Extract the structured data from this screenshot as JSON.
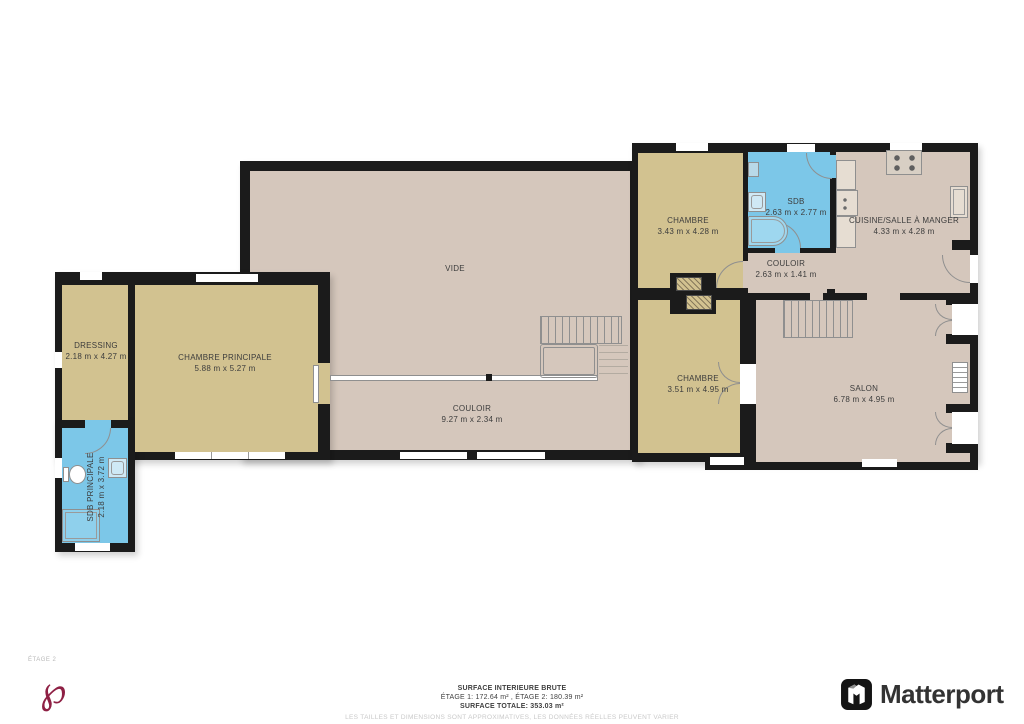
{
  "colors": {
    "wall": "#1b1b1b",
    "floor_common": "#d5c7bc",
    "floor_room": "#d2c290",
    "floor_bath": "#7cc7e8",
    "label_text": "#3c3c3c",
    "logo_red": "#8e2044"
  },
  "rooms": [
    {
      "id": "dressing",
      "name": "DRESSING",
      "dims": "2.18 m x 4.27 m"
    },
    {
      "id": "chambre-principale",
      "name": "CHAMBRE PRINCIPALE",
      "dims": "5.88 m x 5.27 m"
    },
    {
      "id": "sdb-principale",
      "name": "SDB PRINCIPALE",
      "dims": "2.18 m x 3.72 m"
    },
    {
      "id": "vide",
      "name": "VIDE",
      "dims": ""
    },
    {
      "id": "couloir",
      "name": "COULOIR",
      "dims": "9.27 m x 2.34 m"
    },
    {
      "id": "chambre-haut",
      "name": "CHAMBRE",
      "dims": "3.43 m x 4.28 m"
    },
    {
      "id": "sdb",
      "name": "SDB",
      "dims": "2.63 m x 2.77 m"
    },
    {
      "id": "cuisine",
      "name": "CUISINE/SALLE À MANGER",
      "dims": "4.33 m x 4.28 m"
    },
    {
      "id": "couloir-2",
      "name": "COULOIR",
      "dims": "2.63 m x 1.41 m"
    },
    {
      "id": "chambre-bas",
      "name": "CHAMBRE",
      "dims": "3.51 m x 4.95 m"
    },
    {
      "id": "salon",
      "name": "SALON",
      "dims": "6.78 m x 4.95 m"
    }
  ],
  "footer": {
    "floor_label": "ÉTAGE 2",
    "monogram": "℘",
    "line1": "SURFACE INTERIEURE BRUTE",
    "line2": "ÉTAGE 1: 172.64 m² , ÉTAGE 2: 180.39 m²",
    "line3": "SURFACE TOTALE: 353.03 m²",
    "disclaimer": "LES TAILLES ET DIMENSIONS SONT APPROXIMATIVES, LES DONNÉES RÉELLES PEUVENT VARIER",
    "brand": "Matterport"
  }
}
